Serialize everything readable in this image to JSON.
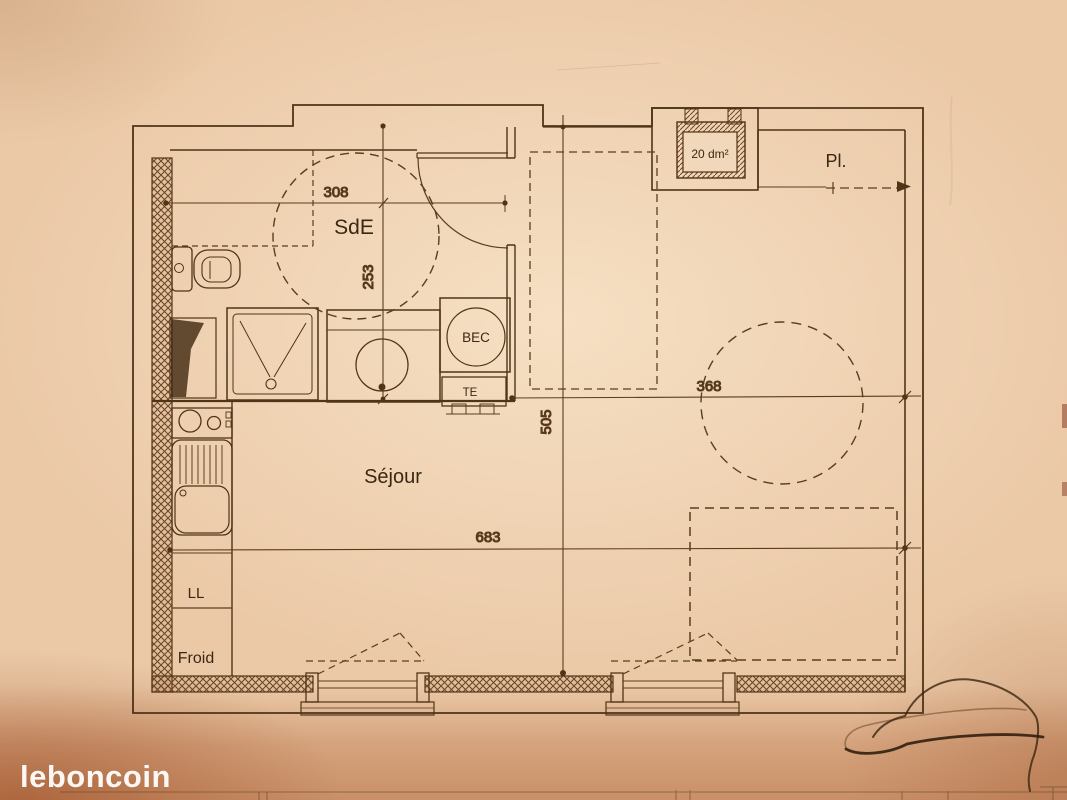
{
  "watermark": {
    "brand": "leboncoin"
  },
  "plan": {
    "rooms": {
      "bathroom": "SdE",
      "living": "Séjour",
      "closet": "Pl."
    },
    "equipment": {
      "water_heater": "BEC",
      "te_unit": "TE",
      "washing_machine": "LL",
      "fridge": "Froid",
      "duct_area": "20 dm²"
    },
    "dimensions": {
      "bathroom_width": "308",
      "bathroom_depth": "253",
      "apartment_depth": "505",
      "right_width": "368",
      "living_width": "683"
    },
    "colors": {
      "paper": "#ebc9a7",
      "ink": "#4f3418",
      "watermark": "#ffffff",
      "bottom_shadow": "#a8582a"
    }
  }
}
